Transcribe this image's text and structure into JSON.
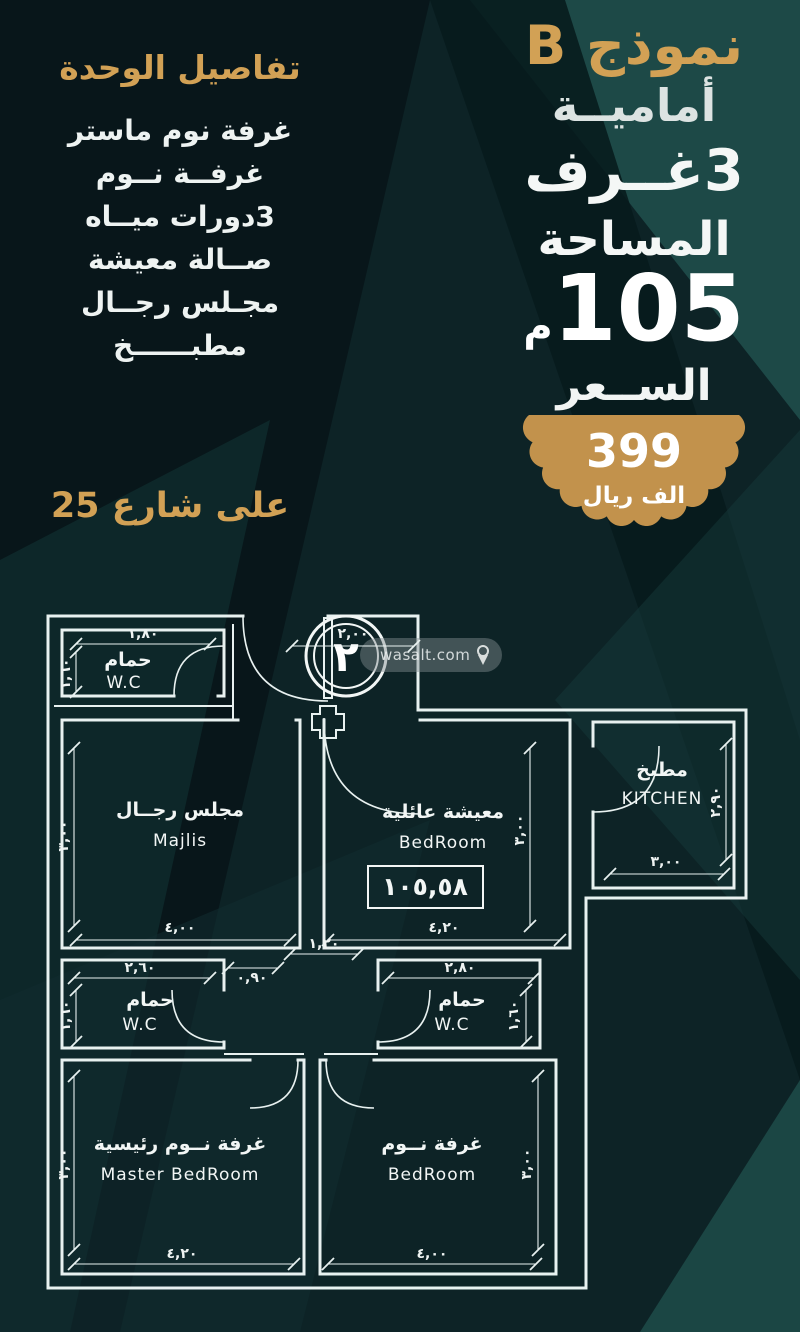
{
  "header_right": {
    "model": "نموذج B",
    "orientation": "أماميــة",
    "rooms_count": "3غــرف",
    "area_label": "المساحة",
    "area_value": "105",
    "area_unit": "م",
    "price_label": "الســعر",
    "price_badge": {
      "value": "399",
      "unit": "الف ريال",
      "color": "#c2924c"
    }
  },
  "unit_details": {
    "title": "تفاصيل الوحدة",
    "items": [
      "غرفة نوم ماستر",
      "غرفــة نــوم",
      "3دورات ميــاه",
      "صــالة معيشة",
      "مجـلس رجــال",
      "مطبــــــخ"
    ]
  },
  "street_note": "على شارع 25",
  "floorplan": {
    "unit_number": "٢",
    "watermark": "wasalt.com",
    "area_box": "١٠٥,٥٨",
    "rooms": {
      "wc_top": {
        "ar": "حمام",
        "en": "W.C"
      },
      "majlis": {
        "ar": "مجلس رجــال",
        "en": "Majlis"
      },
      "living": {
        "ar": "معيشة عائلية",
        "en": "BedRoom"
      },
      "kitchen": {
        "ar": "مطبخ",
        "en": "KITCHEN"
      },
      "wc_left": {
        "ar": "حمام",
        "en": "W.C"
      },
      "wc_right": {
        "ar": "حمام",
        "en": "W.C"
      },
      "master": {
        "ar": "غرفة نــوم رئيسية",
        "en": "Master BedRoom"
      },
      "bedroom": {
        "ar": "غرفة نــوم",
        "en": "BedRoom"
      }
    },
    "dims": {
      "wc_top_w": "١,٨٠",
      "wc_top_h": "١,٦٠",
      "entrance_w": "٢,٠٠",
      "majlis_w": "٤,٠٠",
      "majlis_h": "٣,٠٠",
      "living_w": "٤,٢٠",
      "living_h": "٣,٠٠",
      "kitchen_w": "٣,٠٠",
      "kitchen_h": "٢,٩٠",
      "hall_w": "١,٢٠",
      "door_w": "٠,٩٠",
      "wc_left_w": "٢,٦٠",
      "wc_left_h": "١,٦٠",
      "wc_right_w": "٢,٨٠",
      "wc_right_h": "١,٦٠",
      "master_w": "٤,٢٠",
      "master_h": "٣,٠٠",
      "bedroom_w": "٤,٠٠",
      "bedroom_h": "٣,٠٠"
    }
  },
  "colors": {
    "gold": "#d2a155",
    "background_dark": "#081619",
    "background_teal": "#1d4947",
    "plan_line": "#e8f1f0"
  }
}
